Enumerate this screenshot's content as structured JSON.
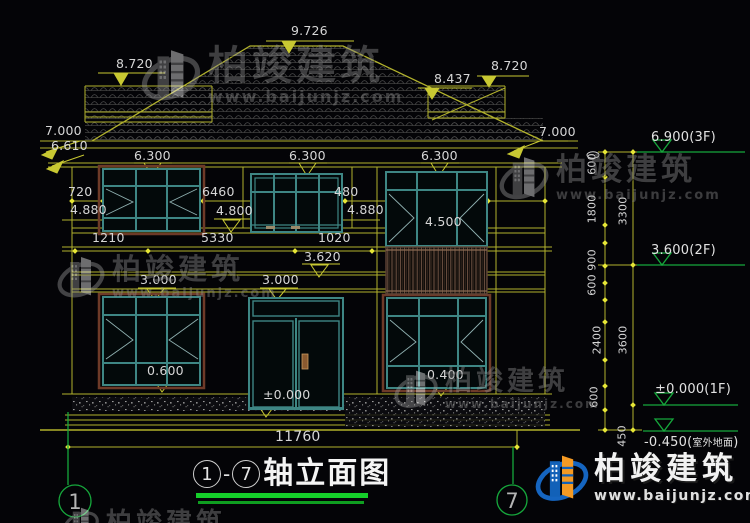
{
  "labels": {
    "ridge": "9.726",
    "left_roof": "8.720",
    "right_roof_inner": "8.437",
    "right_roof": "8.720",
    "eave_l": "7.000",
    "eave_l2": "6.610",
    "eave_r": "7.000",
    "soffit": "6.300",
    "d720": "720",
    "e4880": "4.880",
    "d6460": "6460",
    "e4800": "4.800",
    "d480": "480",
    "e4880r": "4.880",
    "e4500": "4.500",
    "d1210": "1210",
    "d5330": "5330",
    "d1020": "1020",
    "e3620": "3.620",
    "e3000": "3.000",
    "e3000b": "3.000",
    "e0600": "0.600",
    "e0000": "±0.000",
    "e0400": "0.400",
    "total_width": "11760"
  },
  "chain": {
    "s600": "600",
    "s1800": "1800",
    "t3300": "3300",
    "s900": "900",
    "s600b": "600",
    "s2400": "2400",
    "t3600": "3600",
    "s600c": "600",
    "s450": "450"
  },
  "levels": {
    "f3": "6.900(3F)",
    "f2": "3.600(2F)",
    "f1": "±0.000(1F)",
    "ground_num": "-0.450(",
    "ground_cjk": "室外地面",
    "ground_close": ")"
  },
  "title": {
    "start": "1",
    "dash": "-",
    "end": "7",
    "text": "轴立面图"
  },
  "axis": {
    "left": "1",
    "right": "7"
  },
  "watermark": {
    "name": "柏竣建筑",
    "url": "www.baijunjz.com"
  },
  "brand": {
    "name": "柏竣建筑",
    "url": "www.baijunjz.com"
  },
  "colors": {
    "background": "#040407",
    "line_yellow": "#b2b22c",
    "text_white": "#d6d6d6",
    "green": "#16a83c",
    "title_underline": "#15cf2a",
    "window_teal": "#3e8684",
    "frame_brown": "#6e3a28",
    "logo_blue": "#1565c0",
    "logo_orange": "#f59a23"
  }
}
